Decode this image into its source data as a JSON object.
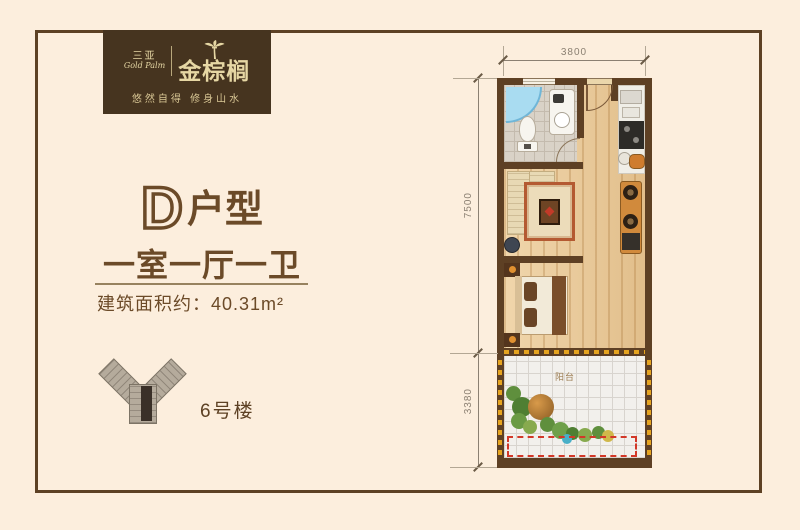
{
  "page": {
    "background": "#fceedd",
    "frame_color": "#5d4124"
  },
  "logo": {
    "city_cn": "三亚",
    "city_en": "Gold Palm",
    "brand": "金棕榈",
    "tagline": "悠然自得 修身山水",
    "bg_color": "#46341f",
    "text_color": "#e6d7a4",
    "icon": "palm-tree-icon"
  },
  "unit": {
    "letter": "D",
    "suffix": "户型",
    "layout": "一室一厅一卫",
    "area_label": "建筑面积约：",
    "area_value": "40.31m²"
  },
  "site": {
    "building_label": "6号楼",
    "icon": "building-siteplan-icon"
  },
  "floorplan": {
    "dim_top": "3800",
    "dim_left_upper": "7500",
    "dim_left_lower": "3380",
    "balcony_label": "阳台",
    "wall_color": "#5e4024",
    "wood_color": "#e7c695",
    "bath_tile_color": "#d9d2c7",
    "balcony_tile_color": "#f2f0ec",
    "shower_color": "#a9dcf1",
    "window_dash_color": "#e6a41f",
    "open_edge_dash_color": "#d23828"
  }
}
